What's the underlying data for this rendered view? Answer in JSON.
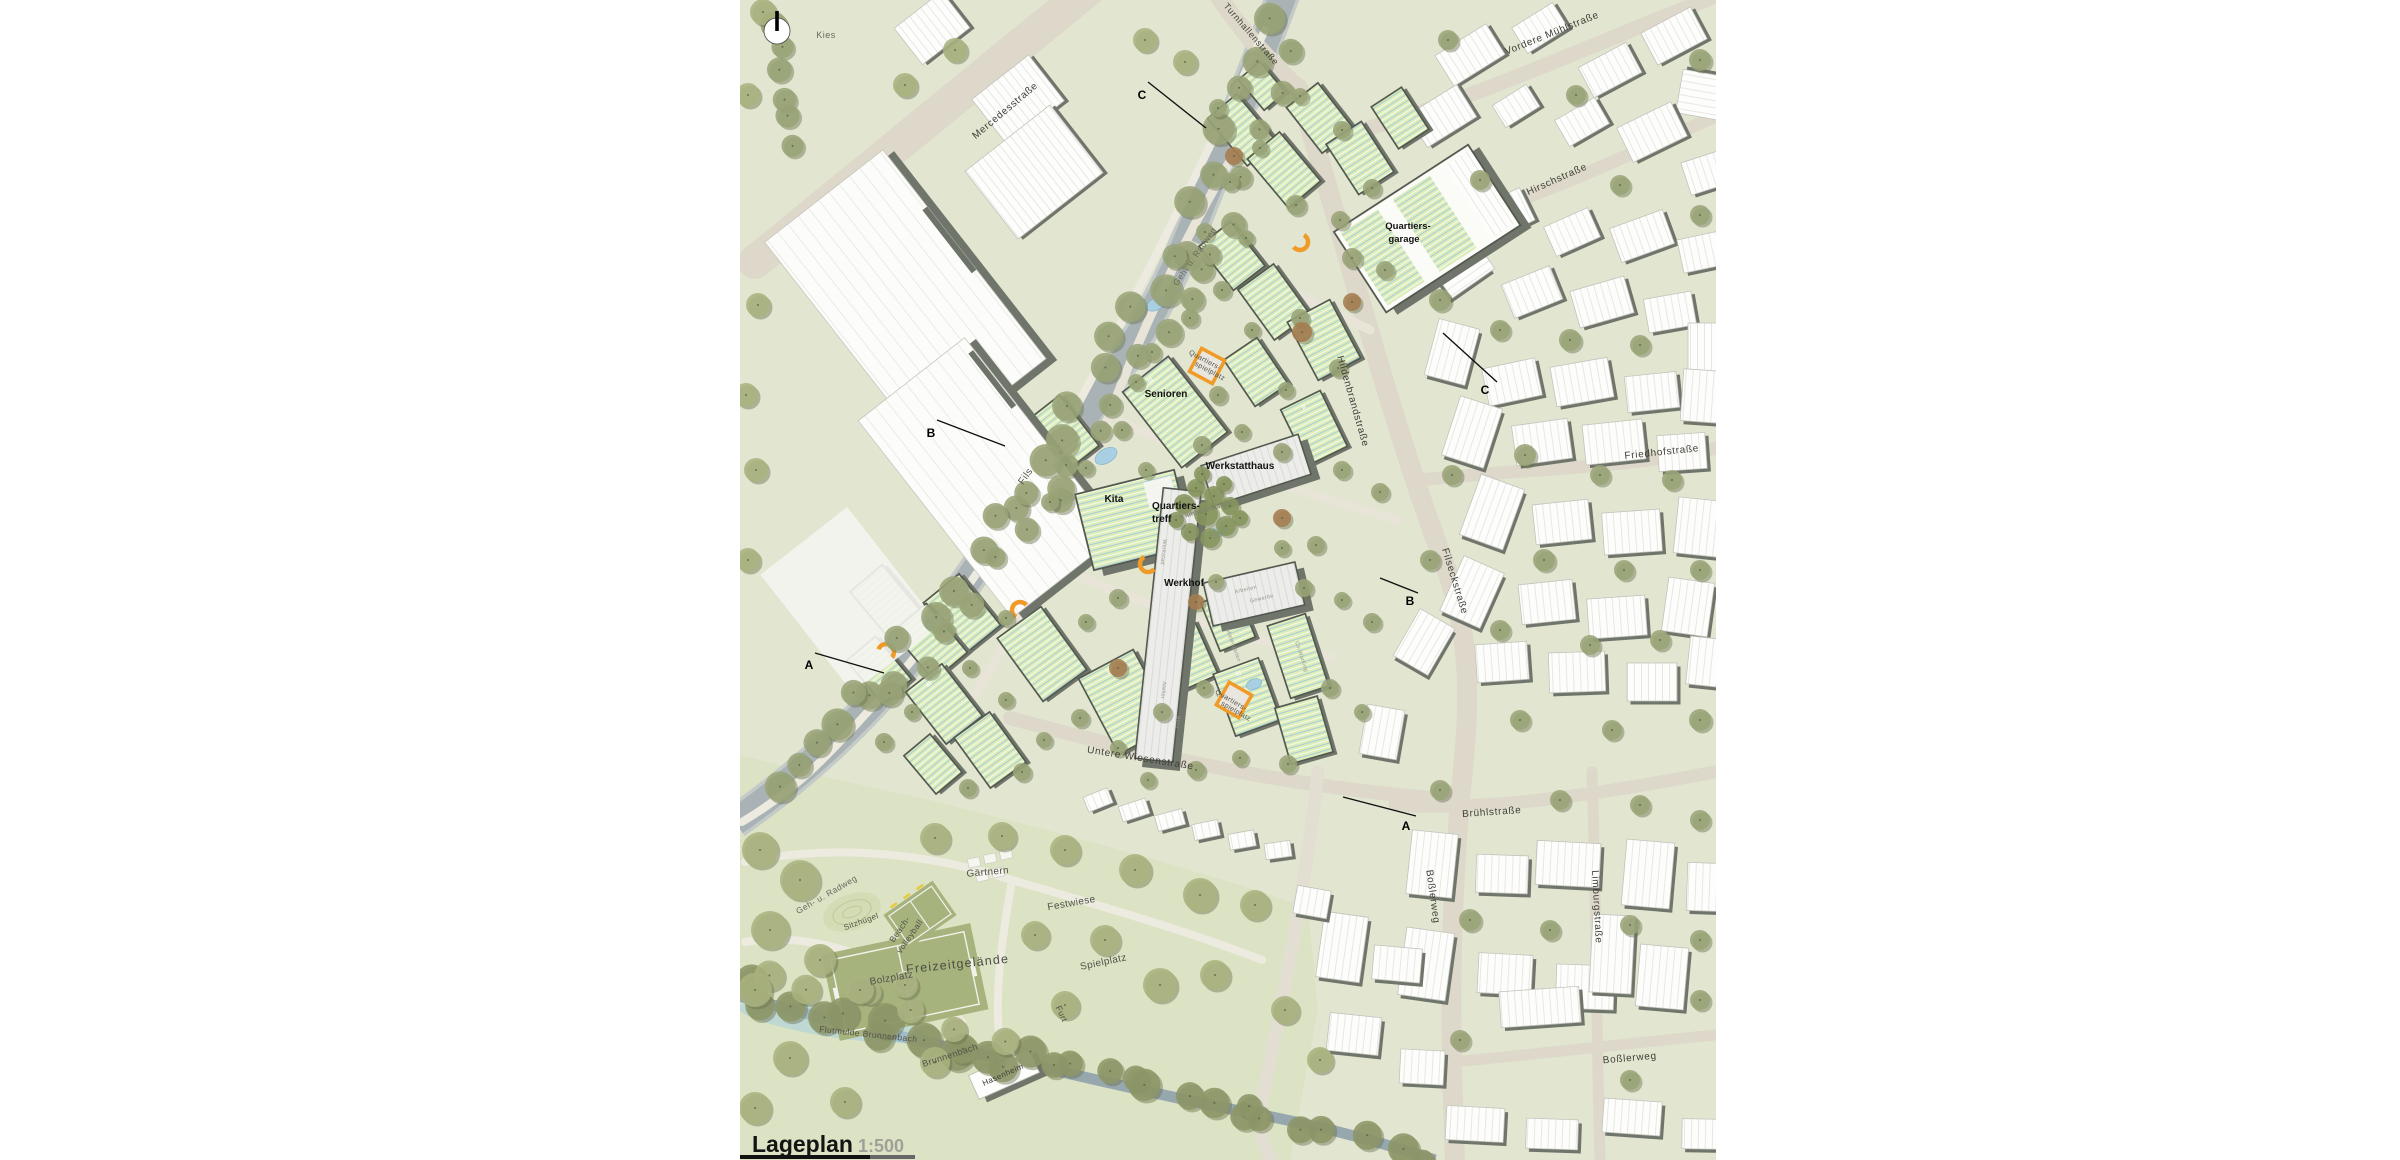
{
  "title": {
    "text": "Lageplan",
    "scale": "1:500"
  },
  "building_labels": {
    "quartiersgarage1": "Quartiers-",
    "quartiersgarage2": "garage",
    "senioren": "Senioren",
    "werkstatthaus": "Werkstatthaus",
    "kita": "Kita",
    "quartierstreff1": "Quartiers-",
    "quartierstreff2": "treff",
    "werkhof": "Werkhof",
    "hasenheim": "Hasenheim"
  },
  "area_labels": {
    "kies": "Kies",
    "fils": "Fils",
    "freizeitgelaende": "Freizeitgelände",
    "bolzplatz": "Bolzplatz",
    "beach1": "Beach-",
    "beach2": "volleyball",
    "sitzhuegel": "Sitzhügel",
    "gaertnern": "Gärtnern",
    "festwiese": "Festwiese",
    "spielplatz": "Spielplatz",
    "flutmulde": "Flutmulde Brunnenbach",
    "brunnenbach": "Brunnenbach",
    "furt": "Furt",
    "hasenheim": "Hasenheim",
    "qsp1a": "Quartiers-",
    "qsp2a": "spielplatz",
    "qsp1b": "Quartiers-",
    "qsp2b": "spielplatz",
    "klimawaeldchen": "Klimawäldchen",
    "gehradweg1": "Geh- u. Radweg",
    "gehradweg2": "Geh- u. Radweg"
  },
  "street_labels": {
    "mercedes": "Mercedesstraße",
    "turnhallen": "Turnhallenstraße",
    "vordere_muehl": "Vordere Mühlstraße",
    "hirsch": "Hirschstraße",
    "friedhof": "Friedhofstraße",
    "filseck": "Filseckstraße",
    "hildenbrand": "Hildenbrandstraße",
    "bruehl": "Brühlstraße",
    "bossler_v": "Boßlerweg",
    "bossler_h": "Boßlerweg",
    "limburg": "Limburgstraße",
    "untere_wiesen": "Untere Wiesenstraße"
  },
  "use_labels": {
    "werkstatt": "Werkstatt",
    "atelier": "Atelier",
    "buero": "Büro",
    "coworking": "Co-Working",
    "arbeiten": "Arbeiten",
    "gewerbe": "Gewerbe",
    "mietergaerten": "Mietergärten"
  },
  "storeys": {
    "s2": "II",
    "s3": "III",
    "s4": "IV"
  },
  "sections": {
    "a": "A",
    "b": "B",
    "c": "C"
  },
  "colors": {
    "base": "#e2e6d0",
    "park": "#dce3c4",
    "road": "#ddd8ca",
    "lane": "#e8e4d8",
    "path": "#edebdf",
    "river": "#a9b2b4",
    "stream": "#97a7ae",
    "water": "#a8cfe2",
    "roof_green": "#dcedb8",
    "roof_stripe": "#a3c8e0",
    "building_edge": "#54594f",
    "building_shadow": "#70756b",
    "white_roof_line": "#e2e2dd",
    "tree": "#9aa478",
    "tree_park": "#aab37f",
    "tree_stream": "#8d9668",
    "tree_dark": "#86955f",
    "tree_brown": "#a57c50",
    "orange": "#f09a28",
    "pitch": "#a6b37d",
    "text_dark": "#121212"
  }
}
